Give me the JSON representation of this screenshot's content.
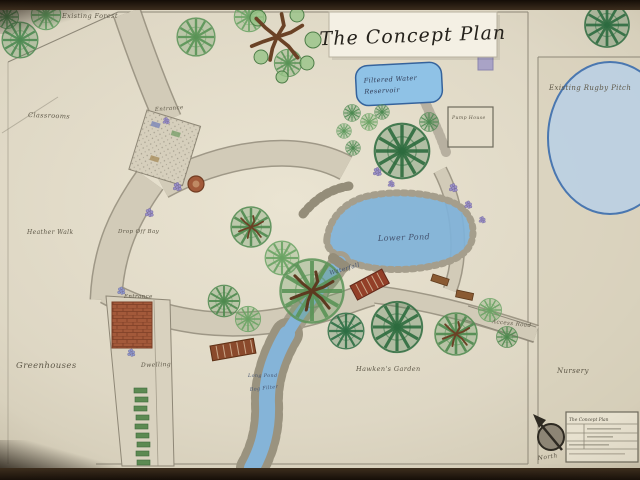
{
  "title": "The Concept Plan",
  "areas": {
    "existing_forest": "Existing Forest",
    "heather_walk": "Heather Walk",
    "hawkens_garden": "Hawken's Garden",
    "access_road": "Access Road",
    "nursery": "Nursery",
    "existing_rugby_pitch": "Existing Rugby Pitch"
  },
  "structures": {
    "classrooms": "Classrooms",
    "entrance_top": "Entrance",
    "drop_off_bay": "Drop Off Bay",
    "entrance_lower": "Entrance",
    "greenhouses": "Greenhouses",
    "dwelling": "Dwelling",
    "pump_house": "Pump House"
  },
  "water_features": {
    "reservoir_line1": "Filtered Water",
    "reservoir_line2": "Reservoir",
    "lower_pond": "Lower Pond",
    "waterfall": "Waterfall",
    "long_pond": "Long Pond",
    "bog_filter": "Bog Filter"
  },
  "compass": {
    "north": "North"
  },
  "title_block": {
    "line1": "The Concept Plan"
  },
  "colors": {
    "paper": "#ddd6c3",
    "pond_blue": "#7fb2d9",
    "reservoir_blue": "#8fc2e6",
    "tree_green": "#4f8a4f",
    "dark_green": "#2d6b3e",
    "brick_brown": "#9a5434",
    "bridge_red": "#933f28",
    "flower_purple": "#9c92c8",
    "pencil_gray": "#8e8878"
  }
}
